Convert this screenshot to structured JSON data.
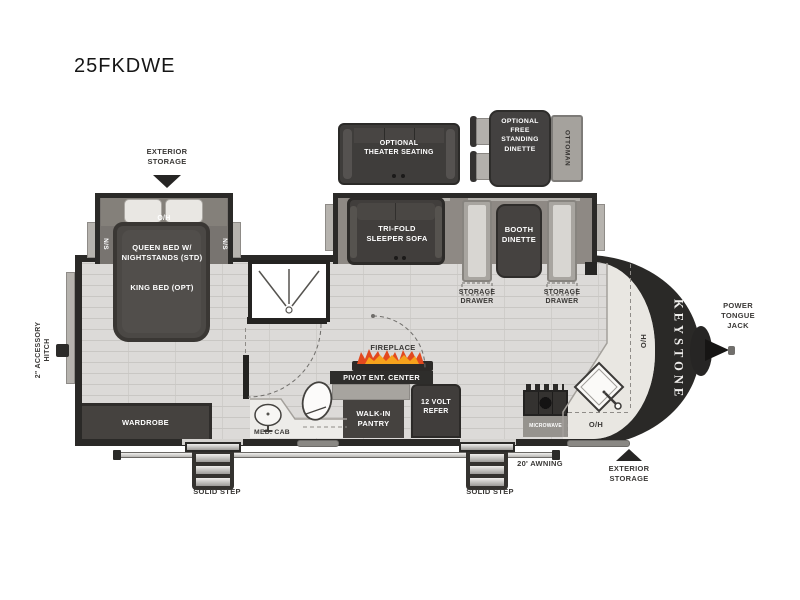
{
  "title": "25FKDWE",
  "brand": "KEYSTONE",
  "exterior": {
    "storage_front": "EXTERIOR\nSTORAGE",
    "storage_rear": "EXTERIOR\nSTORAGE",
    "power_tongue_jack": "POWER\nTONGUE\nJACK",
    "accessory_hitch": "2\" ACCESSORY\nHITCH",
    "awning": "20' AWNING",
    "step_left": "SOLID STEP",
    "step_right": "SOLID STEP"
  },
  "bedroom": {
    "overhead": "O/H",
    "ns_left": "N/S",
    "ns_right": "N/S",
    "bed": "QUEEN BED W/\nNIGHTSTANDS (STD)",
    "bed_option": "KING BED (OPT)",
    "wardrobe": "WARDROBE"
  },
  "bath": {
    "med_cab": "MED. CAB"
  },
  "options": {
    "theater_seating": "OPTIONAL\nTHEATER SEATING",
    "free_standing_dinette": "OPTIONAL\nFREE\nSTANDING\nDINETTE",
    "ottoman": "OTTOMAN"
  },
  "living": {
    "sofa": "TRI-FOLD\nSLEEPER SOFA",
    "booth": "BOOTH\nDINETTE",
    "drawer_left": "STORAGE\nDRAWER",
    "drawer_right": "STORAGE\nDRAWER",
    "fireplace": "FIREPLACE",
    "pivot_ent_center": "PIVOT ENT. CENTER"
  },
  "kitchen": {
    "pantry": "WALK-IN\nPANTRY",
    "refer": "12 VOLT\nREFER",
    "microwave": "MICROWAVE",
    "overhead_counter": "O/H",
    "overhead_side": "O/H"
  },
  "colors": {
    "wall": "#262524",
    "floor": "#dcdad8",
    "counter": "#e9e7e2",
    "furniture_dark": "#45423f",
    "bench_light": "#d8d6d2",
    "label_text": "#3a3836",
    "flame_orange": "#e2491f",
    "flame_yellow": "#f6a21c"
  }
}
